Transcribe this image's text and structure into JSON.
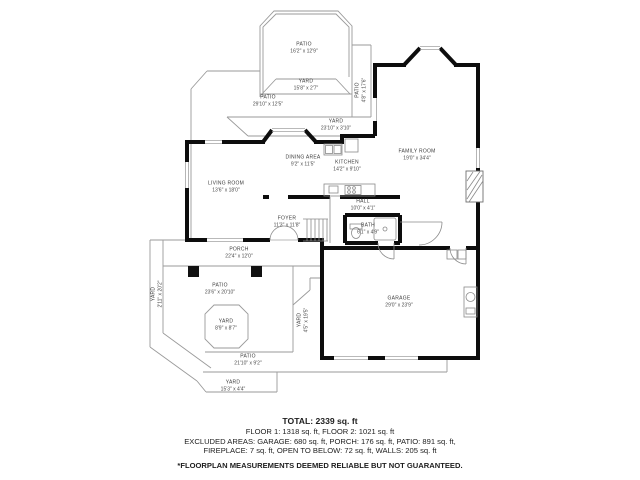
{
  "floorplan": {
    "labels": [
      {
        "name": "PATIO",
        "dims": "16'2\" x 12'9\"",
        "x": 304,
        "y": 48,
        "rot": 0
      },
      {
        "name": "YARD",
        "dims": "15'8\" x 2'7\"",
        "x": 306,
        "y": 85,
        "rot": 0
      },
      {
        "name": "PATIO",
        "dims": "29'10\" x 12'5\"",
        "x": 268,
        "y": 101,
        "rot": 0
      },
      {
        "name": "PATIO",
        "dims": "4'8\" x 17'6\"",
        "x": 361,
        "y": 90,
        "rot": -90
      },
      {
        "name": "YARD",
        "dims": "23'10\" x 3'10\"",
        "x": 336,
        "y": 125,
        "rot": 0
      },
      {
        "name": "FAMILY ROOM",
        "dims": "19'0\" x 34'4\"",
        "x": 417,
        "y": 155,
        "rot": 0
      },
      {
        "name": "DINING AREA",
        "dims": "9'2\" x 11'5\"",
        "x": 303,
        "y": 161,
        "rot": 0
      },
      {
        "name": "KITCHEN",
        "dims": "14'2\" x 9'10\"",
        "x": 347,
        "y": 166,
        "rot": 0
      },
      {
        "name": "LIVING ROOM",
        "dims": "13'6\" x 18'0\"",
        "x": 226,
        "y": 187,
        "rot": 0
      },
      {
        "name": "HALL",
        "dims": "10'0\" x 4'1\"",
        "x": 363,
        "y": 205,
        "rot": 0
      },
      {
        "name": "FOYER",
        "dims": "11'3\" x 11'8\"",
        "x": 287,
        "y": 222,
        "rot": 0
      },
      {
        "name": "BATH",
        "dims": "6'1\" x 4'9\"",
        "x": 368,
        "y": 229,
        "rot": 0
      },
      {
        "name": "PORCH",
        "dims": "22'4\" x 12'0\"",
        "x": 239,
        "y": 253,
        "rot": 0
      },
      {
        "name": "YARD",
        "dims": "2'11\" x 20'2\"",
        "x": 157,
        "y": 294,
        "rot": -90
      },
      {
        "name": "PATIO",
        "dims": "23'6\" x 20'10\"",
        "x": 220,
        "y": 289,
        "rot": 0
      },
      {
        "name": "GARAGE",
        "dims": "29'0\" x 23'9\"",
        "x": 399,
        "y": 302,
        "rot": 0
      },
      {
        "name": "YARD",
        "dims": "8'9\" x 8'7\"",
        "x": 226,
        "y": 325,
        "rot": 0
      },
      {
        "name": "YARD",
        "dims": "4'5\" x 19'5\"",
        "x": 303,
        "y": 320,
        "rot": -90
      },
      {
        "name": "PATIO",
        "dims": "21'10\" x 9'2\"",
        "x": 248,
        "y": 360,
        "rot": 0
      },
      {
        "name": "YARD",
        "dims": "15'3\" x 4'4\"",
        "x": 233,
        "y": 386,
        "rot": 0
      }
    ]
  },
  "summary": {
    "total": "TOTAL: 2339 sq. ft",
    "floors": "FLOOR 1: 1318 sq. ft, FLOOR 2: 1021 sq. ft",
    "excluded1": "EXCLUDED AREAS: GARAGE: 680 sq. ft, PORCH: 176 sq. ft, PATIO: 891 sq. ft,",
    "excluded2": "FIREPLACE: 7 sq. ft, OPEN TO BELOW: 72 sq. ft, WALLS: 205 sq. ft",
    "disclaimer": "*FLOORPLAN MEASUREMENTS DEEMED RELIABLE BUT NOT GUARANTEED."
  }
}
